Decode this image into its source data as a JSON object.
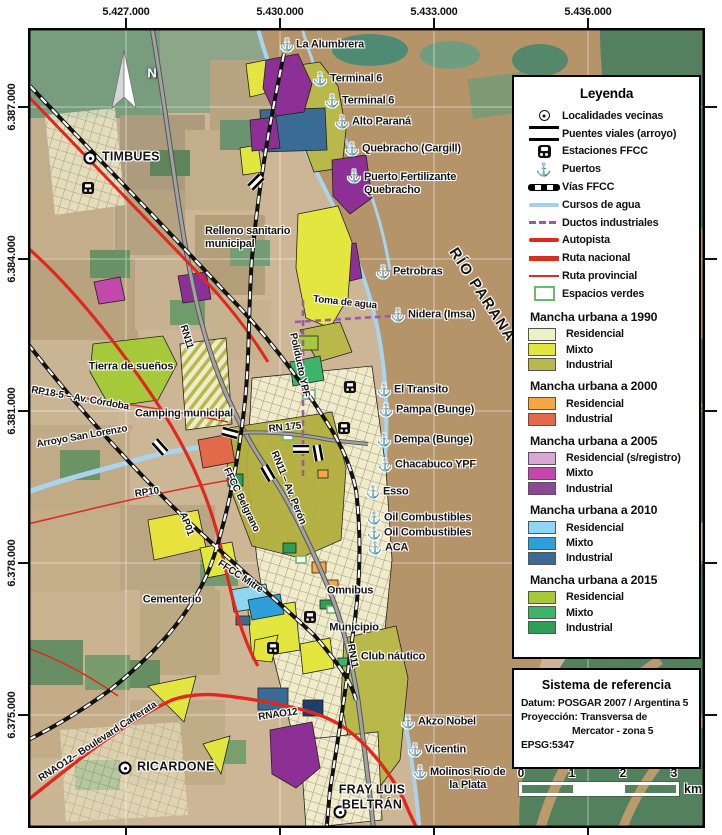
{
  "axes": {
    "top": [
      "5.427.000",
      "5.430.000",
      "5.433.000",
      "5.436.000"
    ],
    "left": [
      "6.387.000",
      "6.384.000",
      "6.381.000",
      "6.378.000",
      "6.375.000"
    ]
  },
  "compass": {
    "north": "N"
  },
  "map": {
    "river_name": "RÍO PARANÁ",
    "localities": {
      "timbues": "TIMBUES",
      "ricardone": "RICARDONE",
      "fray_luis_beltran": "FRAY LUIS\nBELTRÁN"
    },
    "ports": {
      "la_alumbrera": "La Alumbrera",
      "terminal6_a": "Terminal 6",
      "terminal6_b": "Terminal 6",
      "alto_parana": "Alto Paraná",
      "quebracho_cargill": "Quebracho (Cargill)",
      "puerto_fertilizante": "Puerto Fertilizante\nQuebracho",
      "petrobras": "Petrobras",
      "nidera": "Nidera (Imsa)",
      "el_transito": "El Transito",
      "pampa_bunge": "Pampa (Bunge)",
      "dempa_bunge": "Dempa (Bunge)",
      "chacabuco_ypf": "Chacabuco YPF",
      "esso": "Esso",
      "oil_combustibles_a": "Oil Combustibles",
      "oil_combustibles_b": "Oil Combustibles",
      "aca": "ACA",
      "akzo_nobel": "Akzo Nobel",
      "vicentin": "Vicentin",
      "molinos": "Molinos Río de\nla Plata"
    },
    "roads": {
      "rn11": "RN11",
      "rn11_peron": "RN11 – Av. Perón",
      "rn11_south": "RN11",
      "rn175": "RN 175",
      "rp18": "RP18-5 – Av. Córdoba",
      "rp10": "RP10",
      "ap01": "AP01",
      "rna012_blvd": "RNAO12– Boulevard Cafferata",
      "rna012": "RNAO12"
    },
    "railways": {
      "belgrano": "FFCC Belgrano",
      "mitre": "FFCC Mitre"
    },
    "water": {
      "arroyo": "Arroyo San Lorenzo",
      "toma_de_agua": "Toma de agua"
    },
    "ducts": {
      "poliducto_ypf": "Poliducto YPF"
    },
    "places": {
      "relleno": "Relleno sanitario\nmunicipal",
      "tierra_suenos": "Tierra de sueños",
      "camping": "Camping municipal",
      "omnibus": "Omnibus",
      "municipio": "Municipio",
      "club_nautico": "Club náutico",
      "cementerio": "Cementerio"
    }
  },
  "legend": {
    "title": "Leyenda",
    "items": [
      {
        "label": "Localidades vecinas",
        "icon": "locality-marker"
      },
      {
        "label": "Puentes viales (arroyo)",
        "icon": "bridge"
      },
      {
        "label": "Estaciones FFCC",
        "icon": "train-station"
      },
      {
        "label": "Puertos",
        "icon": "anchor"
      },
      {
        "label": "Vías FFCC",
        "icon": "railway"
      },
      {
        "label": "Cursos de agua",
        "icon": "water-line",
        "color": "#a9cfe8"
      },
      {
        "label": "Ductos industriales",
        "icon": "duct-line",
        "color": "#9b59a8"
      },
      {
        "label": "Autopista",
        "icon": "highway-line",
        "color": "#e0281e"
      },
      {
        "label": "Ruta nacional",
        "icon": "national-road-line",
        "color": "#d93025"
      },
      {
        "label": "Ruta provincial",
        "icon": "provincial-road-line",
        "color": "#d93025"
      },
      {
        "label": "Espacios verdes",
        "icon": "green-space",
        "color": "#6cb86c"
      }
    ],
    "groups": [
      {
        "title": "Mancha urbana a 1990",
        "entries": [
          {
            "label": "Residencial",
            "color": "#eef0c8"
          },
          {
            "label": "Mixto",
            "color": "#e3e63e"
          },
          {
            "label": "Industrial",
            "color": "#b9b84a"
          }
        ]
      },
      {
        "title": "Mancha urbana a 2000",
        "entries": [
          {
            "label": "Residencial",
            "color": "#f5a743"
          },
          {
            "label": "Industrial",
            "color": "#e2694a"
          }
        ]
      },
      {
        "title": "Mancha urbana a 2005",
        "entries": [
          {
            "label": "Residencial (s/registro)",
            "color": "#d9a7d4"
          },
          {
            "label": "Mixto",
            "color": "#c249ab"
          },
          {
            "label": "Industrial",
            "color": "#8c4796"
          }
        ]
      },
      {
        "title": "Mancha urbana a 2010",
        "entries": [
          {
            "label": "Residencial",
            "color": "#8ed7f2"
          },
          {
            "label": "Mixto",
            "color": "#2e9fd9"
          },
          {
            "label": "Industrial",
            "color": "#3a6b94"
          }
        ]
      },
      {
        "title": "Mancha urbana a 2015",
        "entries": [
          {
            "label": "Residencial",
            "color": "#a6c93c"
          },
          {
            "label": "Mixto",
            "color": "#3eb46b"
          },
          {
            "label": "Industrial",
            "color": "#2e9e57"
          }
        ]
      }
    ]
  },
  "reference": {
    "title": "Sistema de referencia",
    "datum": "Datum: POSGAR 2007 / Argentina 5",
    "projection_line1": "Proyección: Transversa de",
    "projection_line2": "Mercator - zona 5",
    "epsg": "EPSG:5347"
  },
  "scalebar": {
    "ticks": [
      "0",
      "1",
      "2",
      "3"
    ],
    "unit": "km"
  }
}
